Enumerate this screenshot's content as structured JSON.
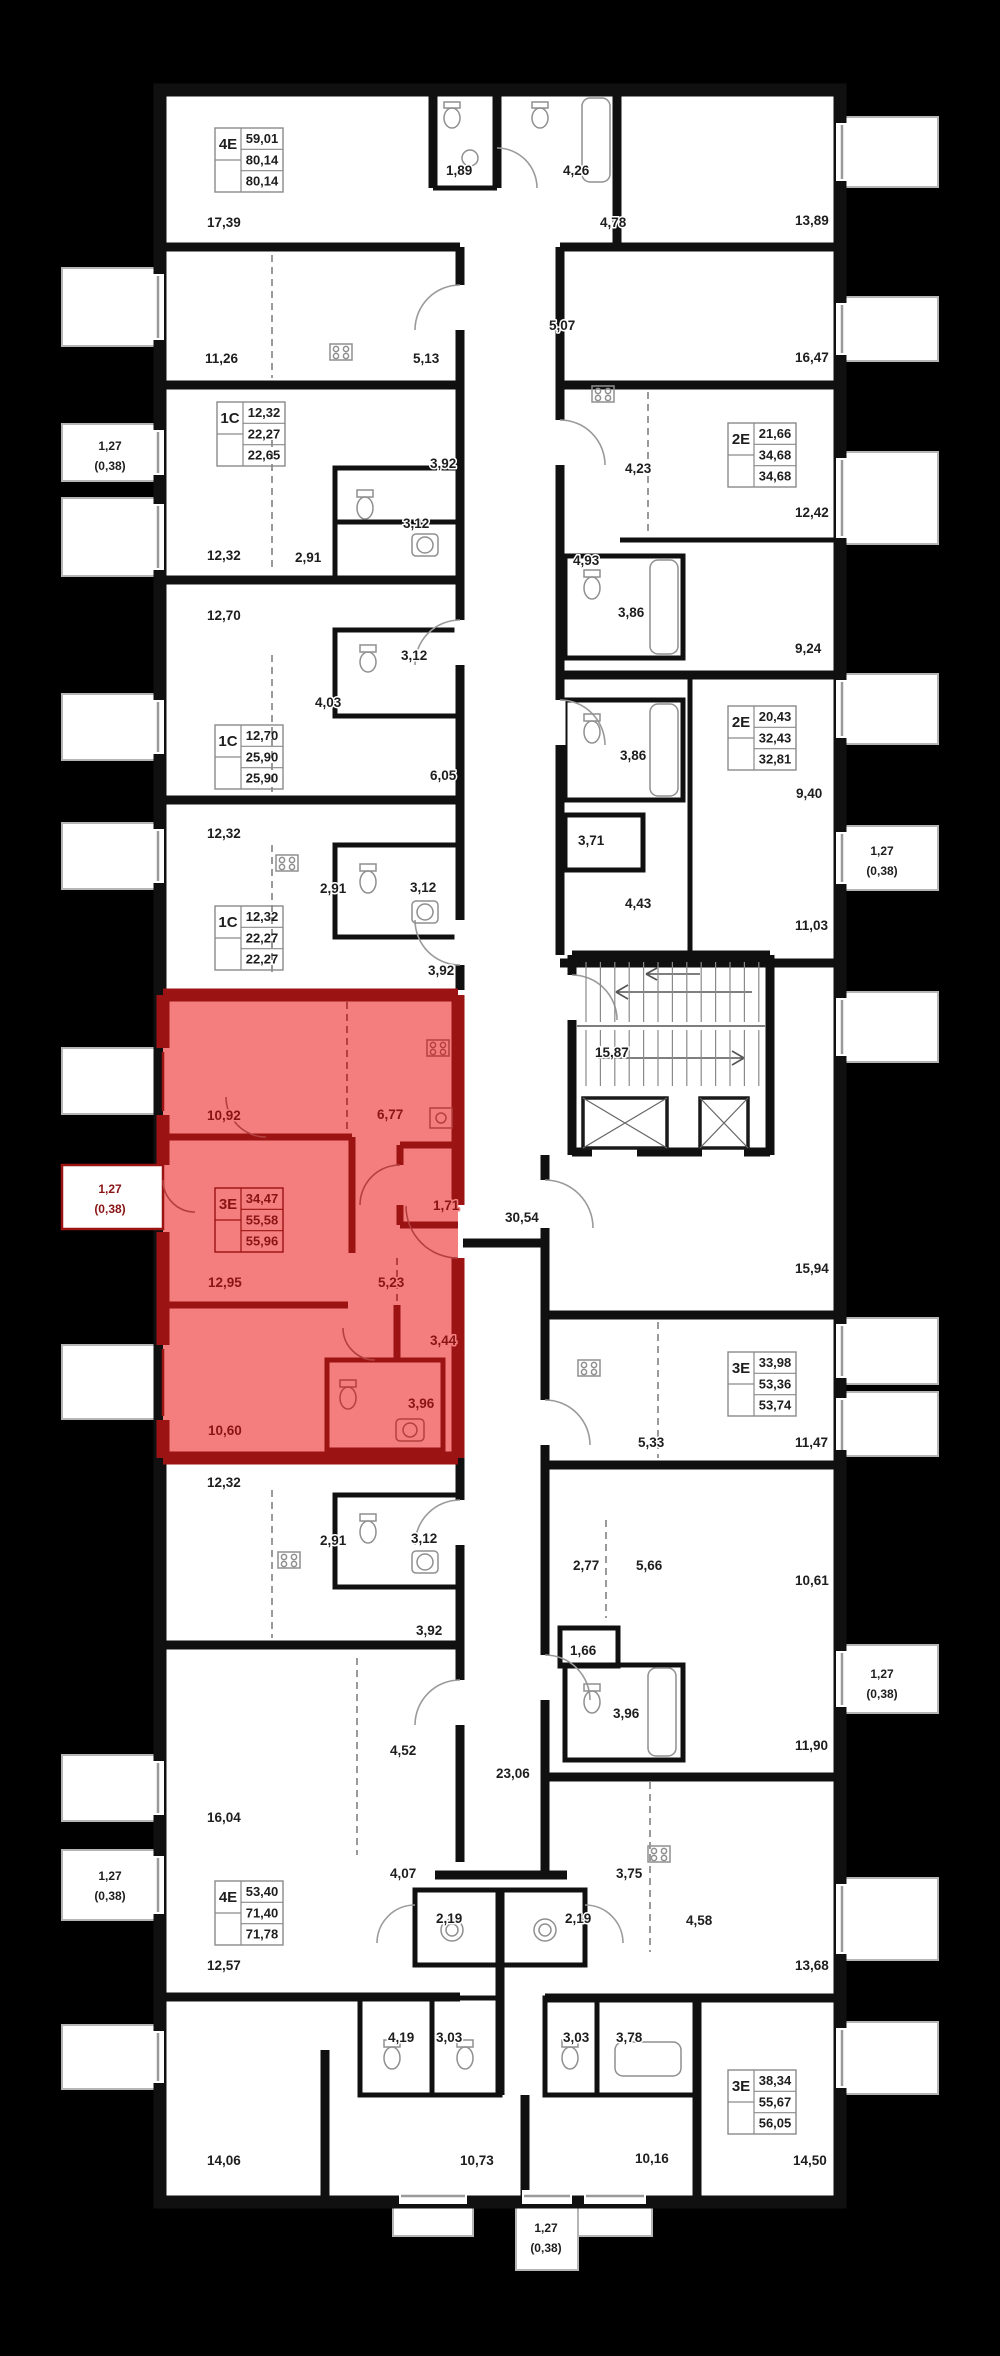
{
  "canvas": {
    "width": 1000,
    "height": 2356,
    "background": "#000000"
  },
  "palette": {
    "plan_fill": "#ffffff",
    "wall_color": "#101010",
    "label_color": "#1e1e1e",
    "gray_line": "#9a9a9a",
    "highlight_fill": "#f47e7e",
    "highlight_wall": "#9b1313",
    "highlight_text": "#8a1414"
  },
  "highlighted_unit": {
    "type": "3Е",
    "values": [
      "34,47",
      "55,58",
      "55,96"
    ]
  },
  "room_labels": [
    {
      "t": "17,39",
      "x": 207,
      "y": 222
    },
    {
      "t": "1,89",
      "x": 446,
      "y": 170
    },
    {
      "t": "4,26",
      "x": 563,
      "y": 170
    },
    {
      "t": "4,78",
      "x": 600,
      "y": 222
    },
    {
      "t": "13,89",
      "x": 795,
      "y": 220
    },
    {
      "t": "11,26",
      "x": 205,
      "y": 358
    },
    {
      "t": "5,13",
      "x": 413,
      "y": 358
    },
    {
      "t": "5,07",
      "x": 549,
      "y": 325
    },
    {
      "t": "16,47",
      "x": 795,
      "y": 357
    },
    {
      "t": "3,92",
      "x": 430,
      "y": 463
    },
    {
      "t": "4,23",
      "x": 625,
      "y": 468
    },
    {
      "t": "12,42",
      "x": 795,
      "y": 512
    },
    {
      "t": "3,12",
      "x": 403,
      "y": 523
    },
    {
      "t": "12,32",
      "x": 207,
      "y": 555
    },
    {
      "t": "2,91",
      "x": 295,
      "y": 557
    },
    {
      "t": "4,93",
      "x": 573,
      "y": 560
    },
    {
      "t": "3,86",
      "x": 618,
      "y": 612
    },
    {
      "t": "12,70",
      "x": 207,
      "y": 615
    },
    {
      "t": "9,24",
      "x": 795,
      "y": 648
    },
    {
      "t": "3,12",
      "x": 401,
      "y": 655
    },
    {
      "t": "4,03",
      "x": 315,
      "y": 702
    },
    {
      "t": "3,86",
      "x": 620,
      "y": 755
    },
    {
      "t": "6,05",
      "x": 430,
      "y": 775
    },
    {
      "t": "9,40",
      "x": 796,
      "y": 793
    },
    {
      "t": "12,32",
      "x": 207,
      "y": 833
    },
    {
      "t": "3,71",
      "x": 578,
      "y": 840
    },
    {
      "t": "2,91",
      "x": 320,
      "y": 888
    },
    {
      "t": "3,12",
      "x": 410,
      "y": 887
    },
    {
      "t": "4,43",
      "x": 625,
      "y": 903
    },
    {
      "t": "11,03",
      "x": 795,
      "y": 925
    },
    {
      "t": "3,92",
      "x": 428,
      "y": 970
    },
    {
      "t": "15,87",
      "x": 595,
      "y": 1052
    },
    {
      "t": "10,92",
      "x": 207,
      "y": 1115,
      "red": true
    },
    {
      "t": "6,77",
      "x": 377,
      "y": 1114,
      "red": true
    },
    {
      "t": "1,71",
      "x": 433,
      "y": 1205,
      "red": true
    },
    {
      "t": "30,54",
      "x": 505,
      "y": 1217
    },
    {
      "t": "15,94",
      "x": 795,
      "y": 1268
    },
    {
      "t": "12,95",
      "x": 208,
      "y": 1282,
      "red": true
    },
    {
      "t": "5,23",
      "x": 378,
      "y": 1282,
      "red": true
    },
    {
      "t": "3,44",
      "x": 430,
      "y": 1340,
      "red": true
    },
    {
      "t": "3,96",
      "x": 408,
      "y": 1403,
      "red": true
    },
    {
      "t": "10,60",
      "x": 208,
      "y": 1430,
      "red": true
    },
    {
      "t": "5,33",
      "x": 638,
      "y": 1442
    },
    {
      "t": "11,47",
      "x": 795,
      "y": 1442
    },
    {
      "t": "12,32",
      "x": 207,
      "y": 1482
    },
    {
      "t": "2,91",
      "x": 320,
      "y": 1540
    },
    {
      "t": "3,12",
      "x": 411,
      "y": 1538
    },
    {
      "t": "2,77",
      "x": 573,
      "y": 1565
    },
    {
      "t": "5,66",
      "x": 636,
      "y": 1565
    },
    {
      "t": "10,61",
      "x": 795,
      "y": 1580
    },
    {
      "t": "3,92",
      "x": 416,
      "y": 1630
    },
    {
      "t": "1,66",
      "x": 570,
      "y": 1650
    },
    {
      "t": "3,96",
      "x": 613,
      "y": 1713
    },
    {
      "t": "4,52",
      "x": 390,
      "y": 1750
    },
    {
      "t": "11,90",
      "x": 795,
      "y": 1745
    },
    {
      "t": "23,06",
      "x": 496,
      "y": 1773
    },
    {
      "t": "16,04",
      "x": 207,
      "y": 1817
    },
    {
      "t": "4,07",
      "x": 390,
      "y": 1873
    },
    {
      "t": "3,75",
      "x": 616,
      "y": 1873
    },
    {
      "t": "2,19",
      "x": 436,
      "y": 1918
    },
    {
      "t": "2,19",
      "x": 565,
      "y": 1918
    },
    {
      "t": "4,58",
      "x": 686,
      "y": 1920
    },
    {
      "t": "12,57",
      "x": 207,
      "y": 1965
    },
    {
      "t": "13,68",
      "x": 795,
      "y": 1965
    },
    {
      "t": "4,19",
      "x": 388,
      "y": 2037
    },
    {
      "t": "3,03",
      "x": 436,
      "y": 2037
    },
    {
      "t": "3,03",
      "x": 563,
      "y": 2037
    },
    {
      "t": "3,78",
      "x": 616,
      "y": 2037
    },
    {
      "t": "14,06",
      "x": 207,
      "y": 2160
    },
    {
      "t": "10,73",
      "x": 460,
      "y": 2160
    },
    {
      "t": "10,16",
      "x": 635,
      "y": 2158
    },
    {
      "t": "14,50",
      "x": 793,
      "y": 2160
    }
  ],
  "unit_boxes": [
    {
      "type": "4Е",
      "values": [
        "59,01",
        "80,14",
        "80,14"
      ],
      "x": 215,
      "y": 128
    },
    {
      "type": "1С",
      "values": [
        "12,32",
        "22,27",
        "22,65"
      ],
      "x": 217,
      "y": 402
    },
    {
      "type": "2Е",
      "values": [
        "21,66",
        "34,68",
        "34,68"
      ],
      "x": 728,
      "y": 423
    },
    {
      "type": "1С",
      "values": [
        "12,70",
        "25,90",
        "25,90"
      ],
      "x": 215,
      "y": 725
    },
    {
      "type": "2Е",
      "values": [
        "20,43",
        "32,43",
        "32,81"
      ],
      "x": 728,
      "y": 706
    },
    {
      "type": "1С",
      "values": [
        "12,32",
        "22,27",
        "22,27"
      ],
      "x": 215,
      "y": 906
    },
    {
      "type": "3Е",
      "values": [
        "34,47",
        "55,58",
        "55,96"
      ],
      "x": 215,
      "y": 1188,
      "red": true
    },
    {
      "type": "3Е",
      "values": [
        "33,98",
        "53,36",
        "53,74"
      ],
      "x": 728,
      "y": 1352
    },
    {
      "type": "4Е",
      "values": [
        "53,40",
        "71,40",
        "71,78"
      ],
      "x": 215,
      "y": 1881
    },
    {
      "type": "3Е",
      "values": [
        "38,34",
        "55,67",
        "56,05"
      ],
      "x": 728,
      "y": 2070
    }
  ],
  "balcony_labels": [
    {
      "lines": [
        "1,27",
        "(0,38)"
      ],
      "x": 110,
      "y": 450
    },
    {
      "lines": [
        "1,27",
        "(0,38)"
      ],
      "x": 110,
      "y": 1193,
      "red": true
    },
    {
      "lines": [
        "1,27",
        "(0,38)"
      ],
      "x": 110,
      "y": 1880
    },
    {
      "lines": [
        "1,27",
        "(0,38)"
      ],
      "x": 882,
      "y": 855
    },
    {
      "lines": [
        "1,27",
        "(0,38)"
      ],
      "x": 882,
      "y": 1678
    },
    {
      "lines": [
        "1,27",
        "(0,38)"
      ],
      "x": 546,
      "y": 2232
    }
  ]
}
